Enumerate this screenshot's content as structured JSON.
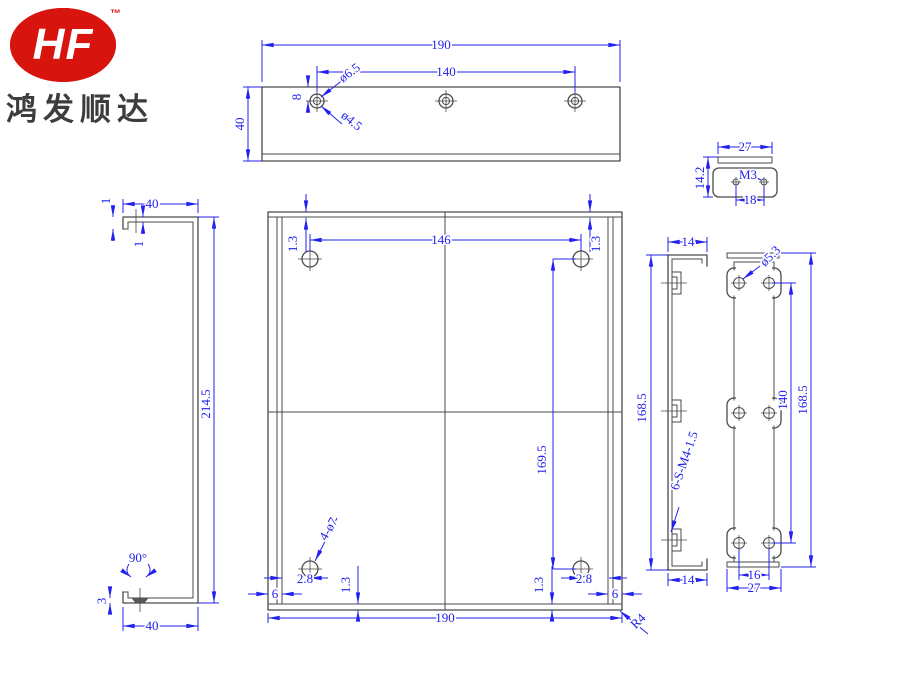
{
  "logo": {
    "brand": "HF",
    "tm": "™",
    "company": "鸿发顺达"
  },
  "colors": {
    "dimension_blue": "#2222ee",
    "geometry_gray": "#4a4a4a",
    "logo_red": "#d8140f"
  },
  "views": {
    "top_view": {
      "dims": {
        "overall_width": "190",
        "hole_span": "140",
        "height": "40",
        "hole_edge_offset": "8",
        "countersink_dia": "ø6.5",
        "hole_dia": "ø4.5"
      }
    },
    "side_view": {
      "dims": {
        "lip": "1",
        "flange_top": "40",
        "thickness": "1",
        "overall_height": "214.5",
        "bend_angle": "90°",
        "csk_depth": "3",
        "flange_bottom": "40"
      }
    },
    "front_view": {
      "dims": {
        "edge_top_left": "1.3",
        "hole_span_h": "146",
        "edge_top_right": "1.3",
        "hole_span_v": "169.5",
        "hole_callout": "4-ø7",
        "offset_left": "2.8",
        "offset_right": "2.8",
        "edge_bottom_left": "1.3",
        "edge_bottom_right": "1.3",
        "flange_left": "6",
        "flange_right": "6",
        "overall_width": "190",
        "corner_radius": "R4"
      }
    },
    "clip_view": {
      "dims": {
        "width": "27",
        "height": "14.2",
        "thread": "M3",
        "hole_span": "18"
      }
    },
    "rail_side_view": {
      "dims": {
        "depth_top": "14",
        "height": "168.5",
        "stud_callout": "6-S-M4-1.5",
        "depth_bottom": "14"
      }
    },
    "rail_front_view": {
      "dims": {
        "hole_dia": "ø5.3",
        "hole_span_v": "140",
        "height": "168.5",
        "hole_span_h": "16",
        "width": "27"
      }
    }
  }
}
